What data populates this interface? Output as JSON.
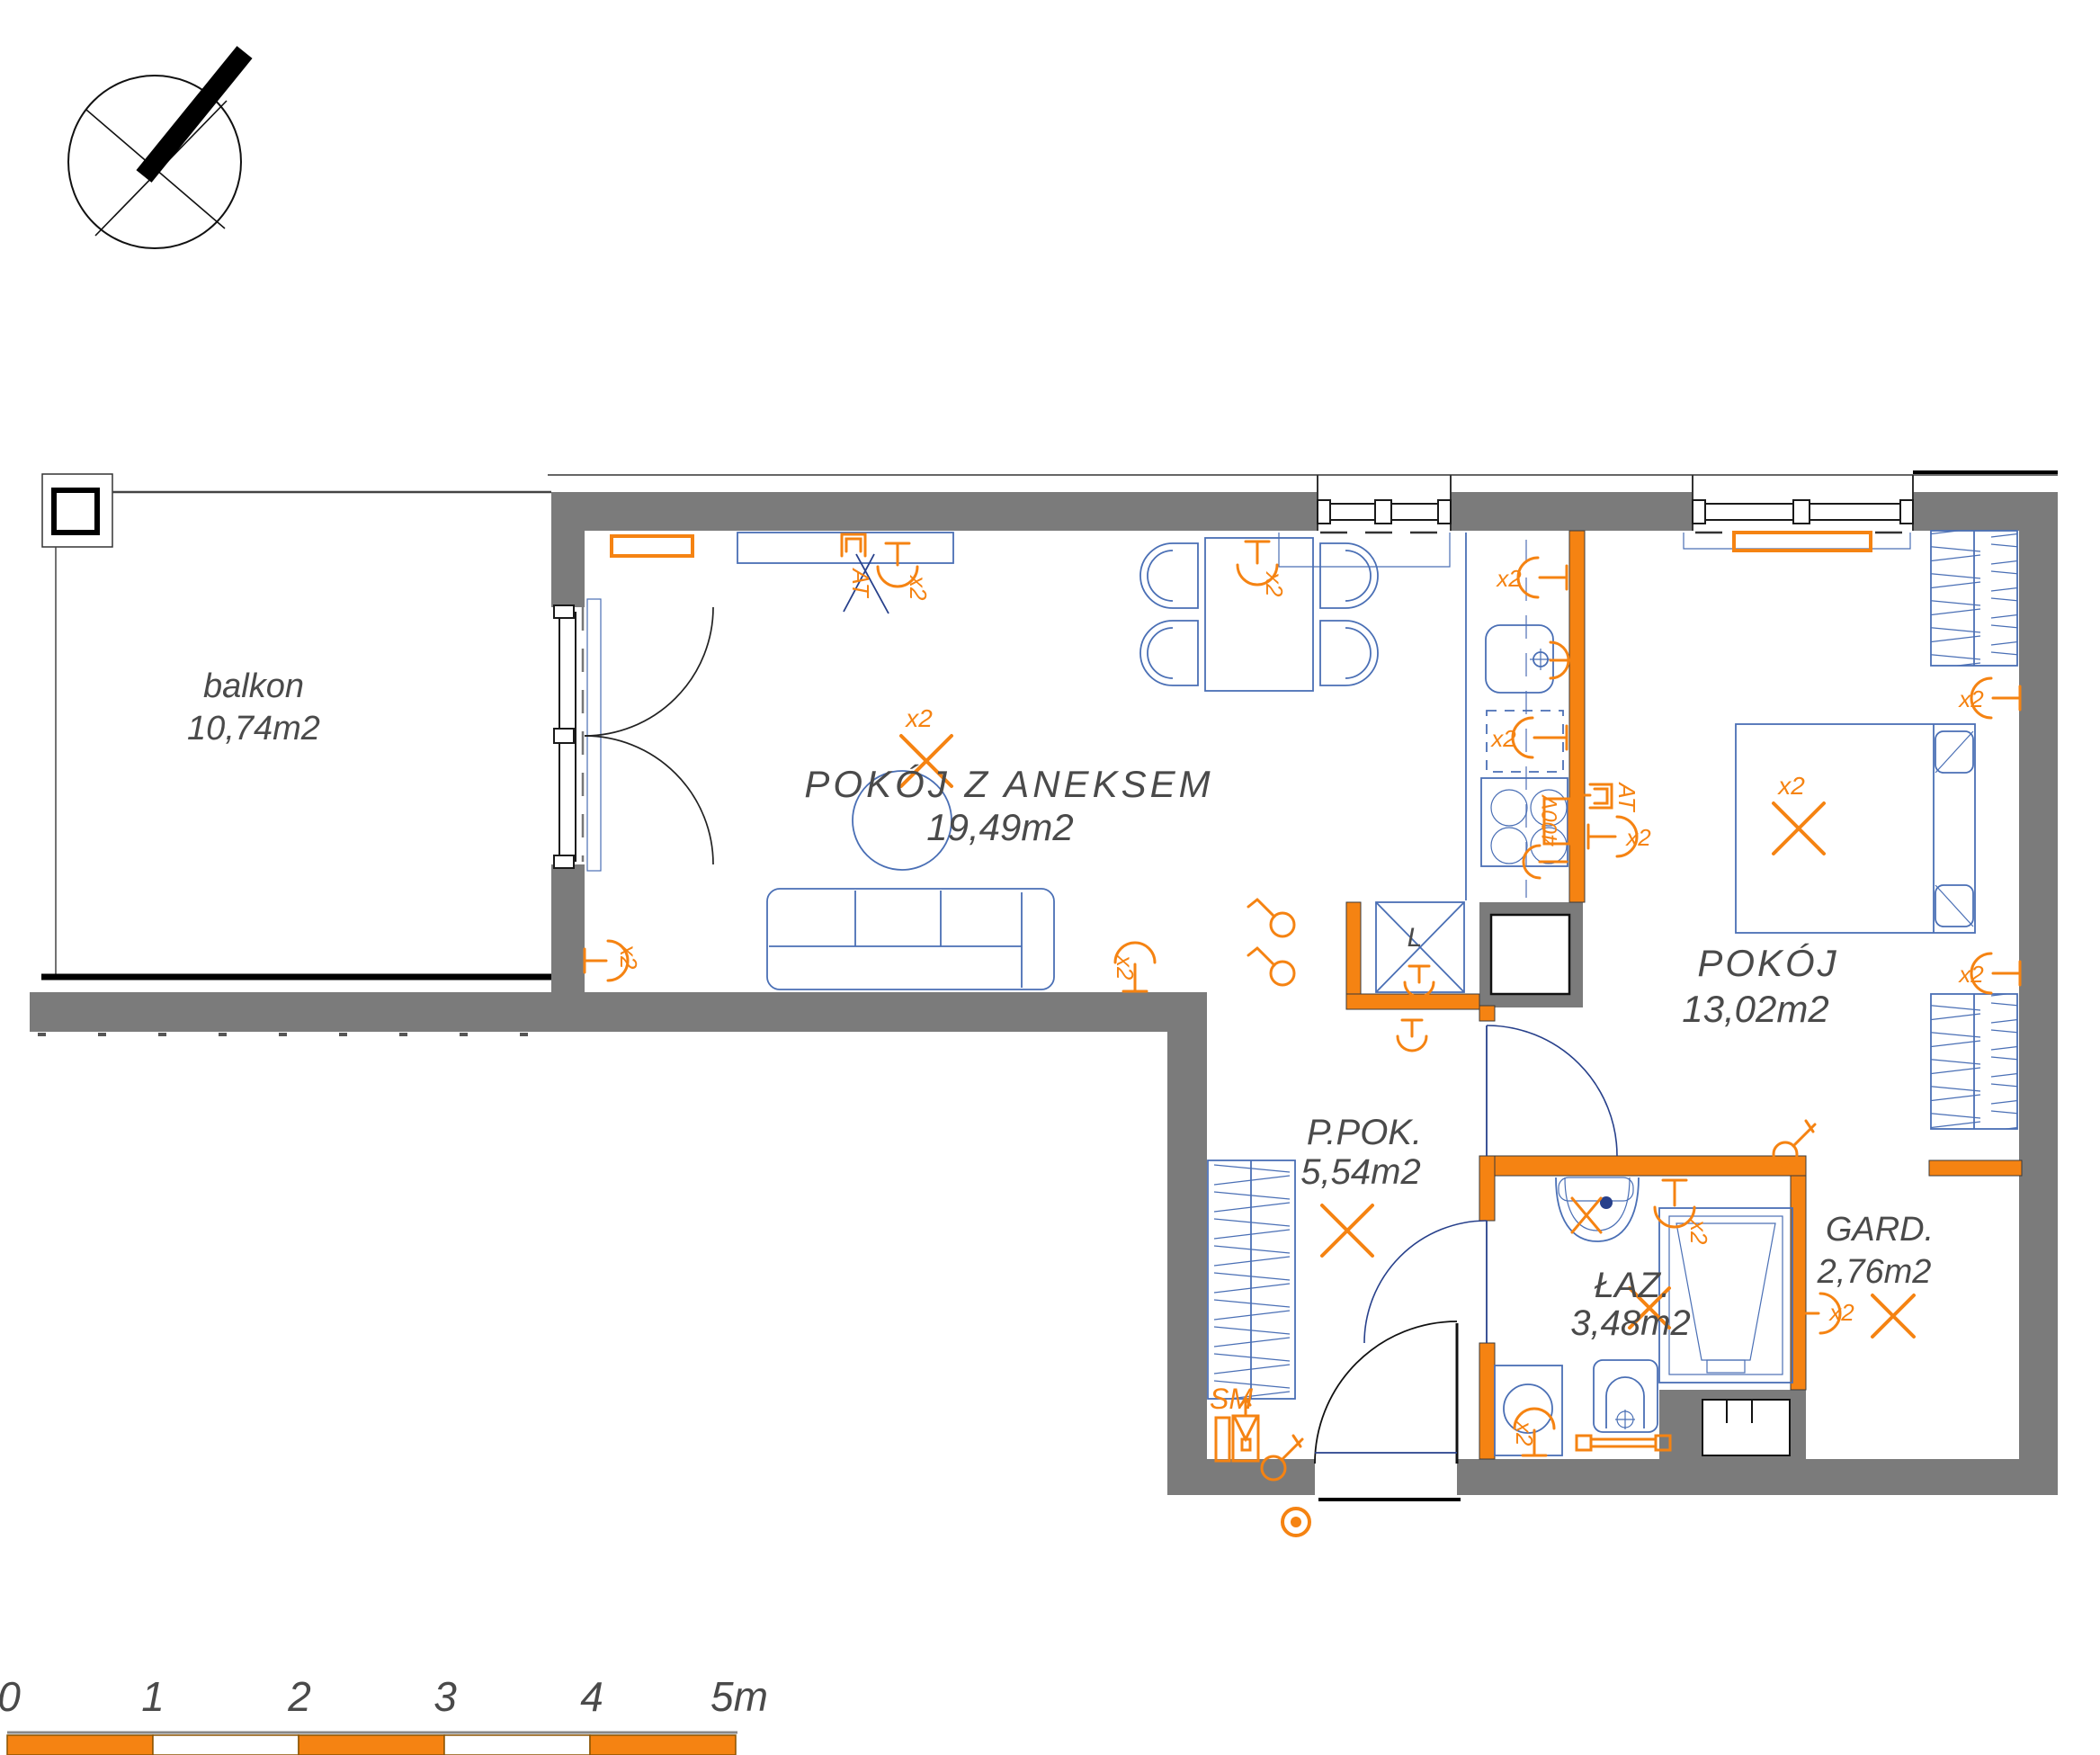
{
  "plan_title": "apartment floor plan",
  "rooms": [
    {
      "id": "balkon",
      "label": "balkon",
      "area": "10,74m2"
    },
    {
      "id": "pokoj_z_aneksem",
      "label": "POKÓJ Z ANEKSEM",
      "area": "19,49m2"
    },
    {
      "id": "pokoj",
      "label": "POKÓJ",
      "area": "13,02m2"
    },
    {
      "id": "ppok",
      "label": "P.POK.",
      "area": "5,54m2"
    },
    {
      "id": "laz",
      "label": "ŁAZ.",
      "area": "3,48m2"
    },
    {
      "id": "gard",
      "label": "GARD.",
      "area": "2,76m2"
    }
  ],
  "symbols": {
    "x2": "x2",
    "at": "AT",
    "v400": "400V",
    "sm": "SM",
    "fridge": "L"
  },
  "scale_bar": {
    "labels": [
      "0",
      "1",
      "2",
      "3",
      "4",
      "5m"
    ]
  },
  "colors": {
    "wall_gray": "#7b7b7b",
    "accent_orange": "#F58312",
    "furniture_blue": "#4a6fb5",
    "door_navy": "#27408b",
    "label_gray": "#4a4a4a"
  }
}
